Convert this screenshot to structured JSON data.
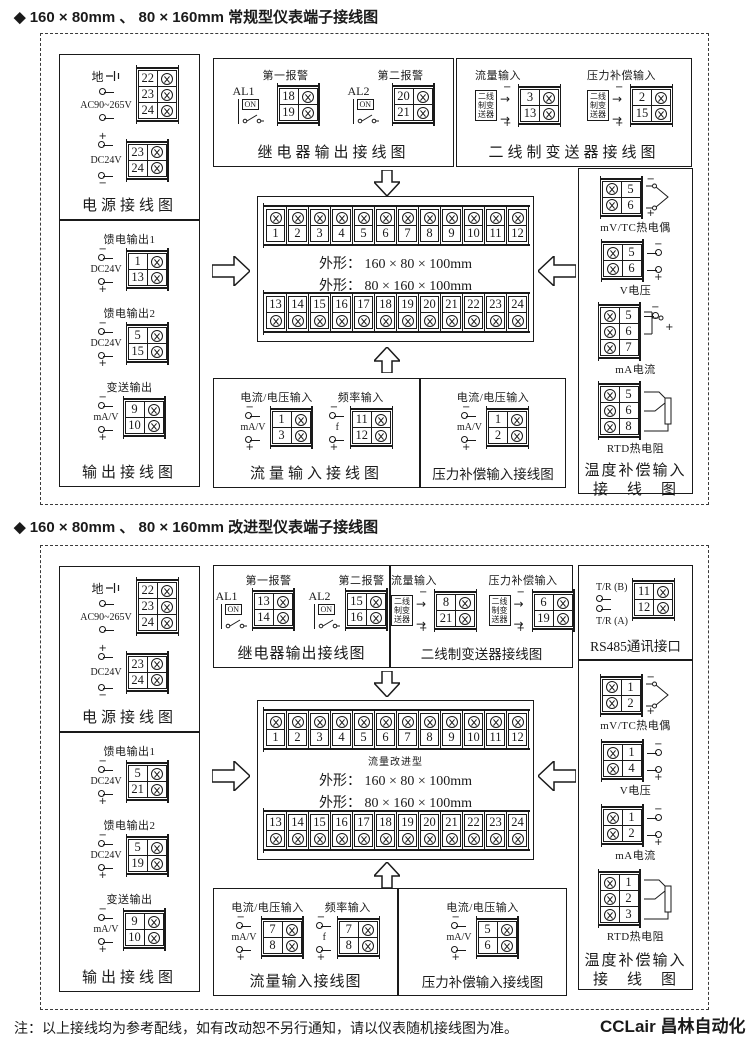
{
  "colors": {
    "paper": "#ffffff",
    "ink": "#1a1a1a"
  },
  "doc": {
    "title1": "◆ 160 × 80mm 、 80 × 160mm 常规型仪表端子接线图",
    "title2": "◆ 160 × 80mm 、 80 × 160mm 改进型仪表端子接线图",
    "note": "注：以上接线均为参考配线，如有改动恕不另行通知，请以仪表随机接线图为准。",
    "watermark": "CCLair 昌林自动化"
  },
  "s1": {
    "power": {
      "title": "电源接线图",
      "ground_label": "地",
      "ac_label": "AC90~265V",
      "top_terms": [
        "22",
        "23",
        "24"
      ],
      "dc_label": "DC24V",
      "dc_signs": [
        "+",
        "−"
      ],
      "dc_terms": [
        "23",
        "24"
      ]
    },
    "output": {
      "title": "输出接线图",
      "groups": [
        {
          "name": "馈电输出1",
          "label": "DC24V",
          "signs": [
            "−",
            "+"
          ],
          "terms": [
            "1",
            "13"
          ]
        },
        {
          "name": "馈电输出2",
          "label": "DC24V",
          "signs": [
            "−",
            "+"
          ],
          "terms": [
            "5",
            "15"
          ]
        },
        {
          "name": "变送输出",
          "label": "mA/V",
          "signs": [
            "−",
            "+"
          ],
          "terms": [
            "9",
            "10"
          ]
        }
      ]
    },
    "relay": {
      "title": "继电器输出接线图",
      "alarms": [
        {
          "name": "第一报警",
          "tag": "AL1",
          "sw": "ON",
          "terms": [
            "18",
            "19"
          ]
        },
        {
          "name": "第二报警",
          "tag": "AL2",
          "sw": "ON",
          "terms": [
            "20",
            "21"
          ]
        }
      ]
    },
    "trans": {
      "title": "二线制变送器接线图",
      "box": [
        "二线",
        "制变",
        "送器"
      ],
      "groups": [
        {
          "name": "流量输入",
          "signs": [
            "−",
            "+"
          ],
          "terms": [
            "3",
            "13"
          ]
        },
        {
          "name": "压力补偿输入",
          "signs": [
            "−",
            "+"
          ],
          "terms": [
            "2",
            "15"
          ]
        }
      ]
    },
    "center": {
      "row_top": [
        "1",
        "2",
        "3",
        "4",
        "5",
        "6",
        "7",
        "8",
        "9",
        "10",
        "11",
        "12"
      ],
      "row_bottom": [
        "13",
        "14",
        "15",
        "16",
        "17",
        "18",
        "19",
        "20",
        "21",
        "22",
        "23",
        "24"
      ],
      "dims": [
        "外形：  160 × 80 × 100mm",
        "外形：  80 × 160 × 100mm"
      ]
    },
    "flow": {
      "title": "流量输入接线图",
      "groups": [
        {
          "name": "电流/电压输入",
          "label": "mA/V",
          "signs": [
            "−",
            "+"
          ],
          "terms": [
            "1",
            "3"
          ]
        },
        {
          "name": "频率输入",
          "label": "f",
          "signs": [
            "−",
            "+"
          ],
          "terms": [
            "11",
            "12"
          ]
        }
      ]
    },
    "pressure": {
      "title": "压力补偿输入接线图",
      "groups": [
        {
          "name": "电流/电压输入",
          "label": "mA/V",
          "signs": [
            "−",
            "+"
          ],
          "terms": [
            "1",
            "2"
          ]
        }
      ]
    },
    "temp": {
      "title1": "温度补偿输入",
      "title2": "接　线　图",
      "groups": [
        {
          "name": "mV/TC热电偶",
          "signs": [
            "−",
            "+"
          ],
          "terms": [
            "5",
            "6"
          ]
        },
        {
          "name": "V电压",
          "signs": [
            "−",
            "+"
          ],
          "terms": [
            "5",
            "6"
          ]
        },
        {
          "name": "mA电流",
          "signs": [
            "−",
            "+"
          ],
          "terms": [
            "5",
            "6",
            "7"
          ]
        },
        {
          "name": "RTD热电阻",
          "terms": [
            "5",
            "6",
            "8"
          ]
        }
      ]
    }
  },
  "s2": {
    "power": {
      "title": "电源接线图",
      "ground_label": "地",
      "ac_label": "AC90~265V",
      "top_terms": [
        "22",
        "23",
        "24"
      ],
      "dc_label": "DC24V",
      "dc_signs": [
        "+",
        "−"
      ],
      "dc_terms": [
        "23",
        "24"
      ]
    },
    "output": {
      "title": "输出接线图",
      "groups": [
        {
          "name": "馈电输出1",
          "label": "DC24V",
          "signs": [
            "−",
            "+"
          ],
          "terms": [
            "5",
            "21"
          ]
        },
        {
          "name": "馈电输出2",
          "label": "DC24V",
          "signs": [
            "−",
            "+"
          ],
          "terms": [
            "5",
            "19"
          ]
        },
        {
          "name": "变送输出",
          "label": "mA/V",
          "signs": [
            "−",
            "+"
          ],
          "terms": [
            "9",
            "10"
          ]
        }
      ]
    },
    "relay": {
      "title": "继电器输出接线图",
      "alarms": [
        {
          "name": "第一报警",
          "tag": "AL1",
          "sw": "ON",
          "terms": [
            "13",
            "14"
          ]
        },
        {
          "name": "第二报警",
          "tag": "AL2",
          "sw": "ON",
          "terms": [
            "15",
            "16"
          ]
        }
      ]
    },
    "trans": {
      "title": "二线制变送器接线图",
      "box": [
        "二线",
        "制变",
        "送器"
      ],
      "groups": [
        {
          "name": "流量输入",
          "signs": [
            "−",
            "+"
          ],
          "terms": [
            "8",
            "21"
          ]
        },
        {
          "name": "压力补偿输入",
          "signs": [
            "−",
            "+"
          ],
          "terms": [
            "6",
            "19"
          ]
        }
      ]
    },
    "center": {
      "type_label": "流量改进型",
      "row_top": [
        "1",
        "2",
        "3",
        "4",
        "5",
        "6",
        "7",
        "8",
        "9",
        "10",
        "11",
        "12"
      ],
      "row_bottom": [
        "13",
        "14",
        "15",
        "16",
        "17",
        "18",
        "19",
        "20",
        "21",
        "22",
        "23",
        "24"
      ],
      "dims": [
        "外形：  160 × 80 × 100mm",
        "外形：  80 × 160 × 100mm"
      ]
    },
    "flow": {
      "title": "流量输入接线图",
      "groups": [
        {
          "name": "电流/电压输入",
          "label": "mA/V",
          "signs": [
            "−",
            "+"
          ],
          "terms": [
            "7",
            "8"
          ]
        },
        {
          "name": "频率输入",
          "label": "f",
          "signs": [
            "−",
            "+"
          ],
          "terms": [
            "7",
            "8"
          ]
        }
      ]
    },
    "pressure": {
      "title": "压力补偿输入接线图",
      "groups": [
        {
          "name": "电流/电压输入",
          "label": "mA/V",
          "signs": [
            "−",
            "+"
          ],
          "terms": [
            "5",
            "6"
          ]
        }
      ]
    },
    "rs485": {
      "title": "RS485通讯接口",
      "lines": [
        {
          "label": "T/R (B)",
          "term": "11"
        },
        {
          "label": "T/R (A)",
          "term": "12"
        }
      ]
    },
    "temp": {
      "title1": "温度补偿输入",
      "title2": "接　线　图",
      "groups": [
        {
          "name": "mV/TC热电偶",
          "signs": [
            "−",
            "+"
          ],
          "terms": [
            "1",
            "2"
          ]
        },
        {
          "name": "V电压",
          "signs": [
            "−",
            "+"
          ],
          "terms": [
            "1",
            "4"
          ]
        },
        {
          "name": "mA电流",
          "signs": [
            "−",
            "+"
          ],
          "terms": [
            "1",
            "2"
          ]
        },
        {
          "name": "RTD热电阻",
          "terms": [
            "1",
            "2",
            "3"
          ]
        }
      ]
    }
  }
}
